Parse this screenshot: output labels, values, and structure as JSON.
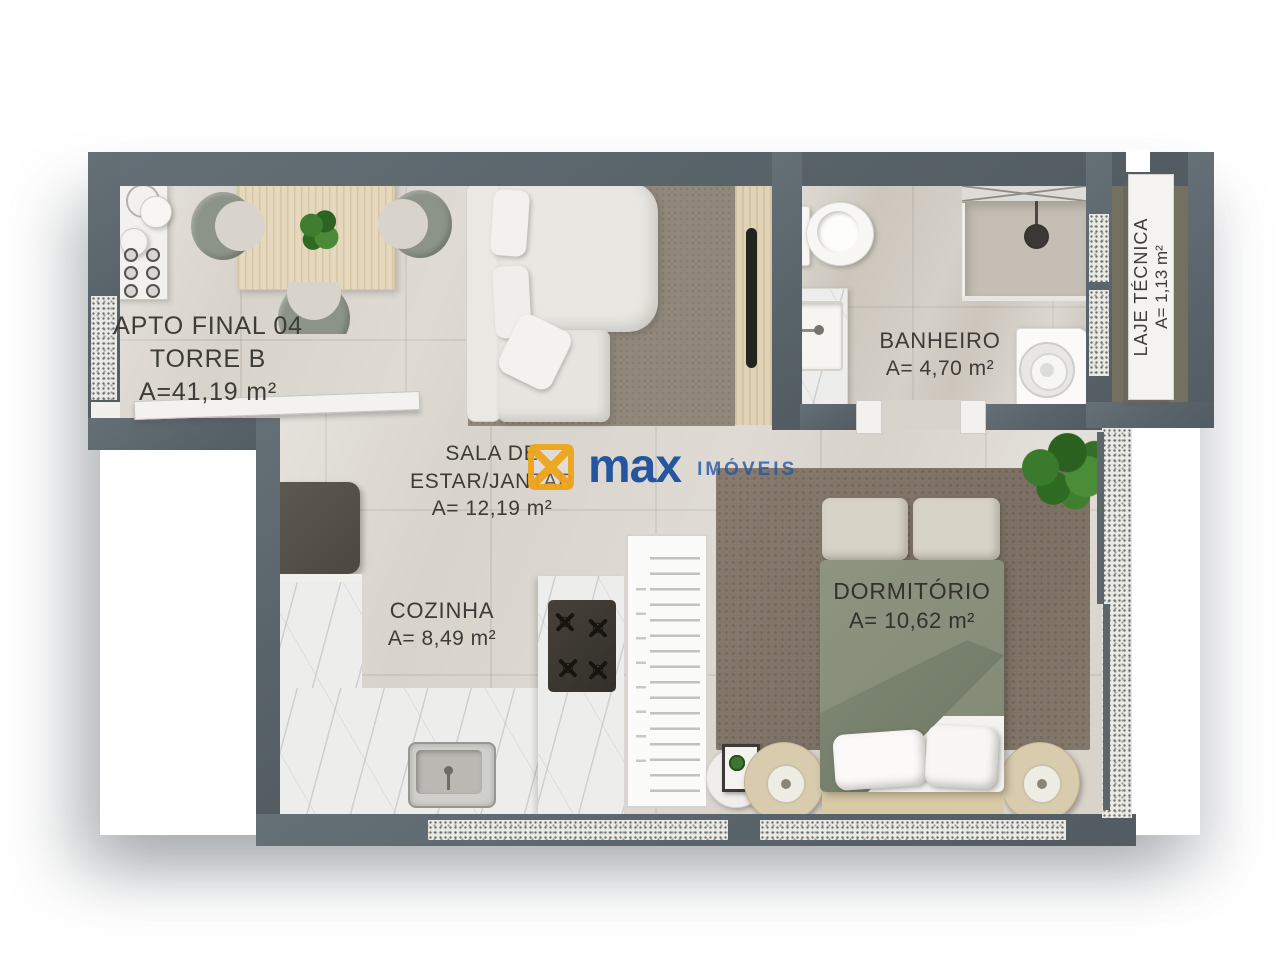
{
  "plan": {
    "apto": {
      "line1": "APTO FINAL 04",
      "line2": "TORRE B",
      "area": "A=41,19 m²"
    },
    "banheiro": {
      "name": "BANHEIRO",
      "area": "A= 4,70 m²"
    },
    "laje_tecnica": {
      "name": "LAJE TÉCNICA",
      "area": "A= 1,13 m²"
    },
    "sala": {
      "line1": "SALA DE",
      "line2": "ESTAR/JANTAR",
      "area": "A= 12,19 m²"
    },
    "cozinha": {
      "name": "COZINHA",
      "area": "A= 8,49 m²"
    },
    "dormitorio": {
      "name": "DORMITÓRIO",
      "area": "A= 10,62 m²"
    }
  },
  "watermark": {
    "brand": "max",
    "suffix": "IMÓVEIS",
    "icon": "max-logo-box-x-icon"
  },
  "colors": {
    "wall": "#5D666B",
    "floor": "#D8D3CB",
    "bathroom_floor": "#CCC6BC",
    "laje_floor": "#73705F",
    "logo_blue": "#1D4F9E",
    "logo_gold": "#EEA51D",
    "bed_green": "#89917D",
    "rug_brown": "#82776A",
    "sofa_white": "#E9E7E2"
  }
}
